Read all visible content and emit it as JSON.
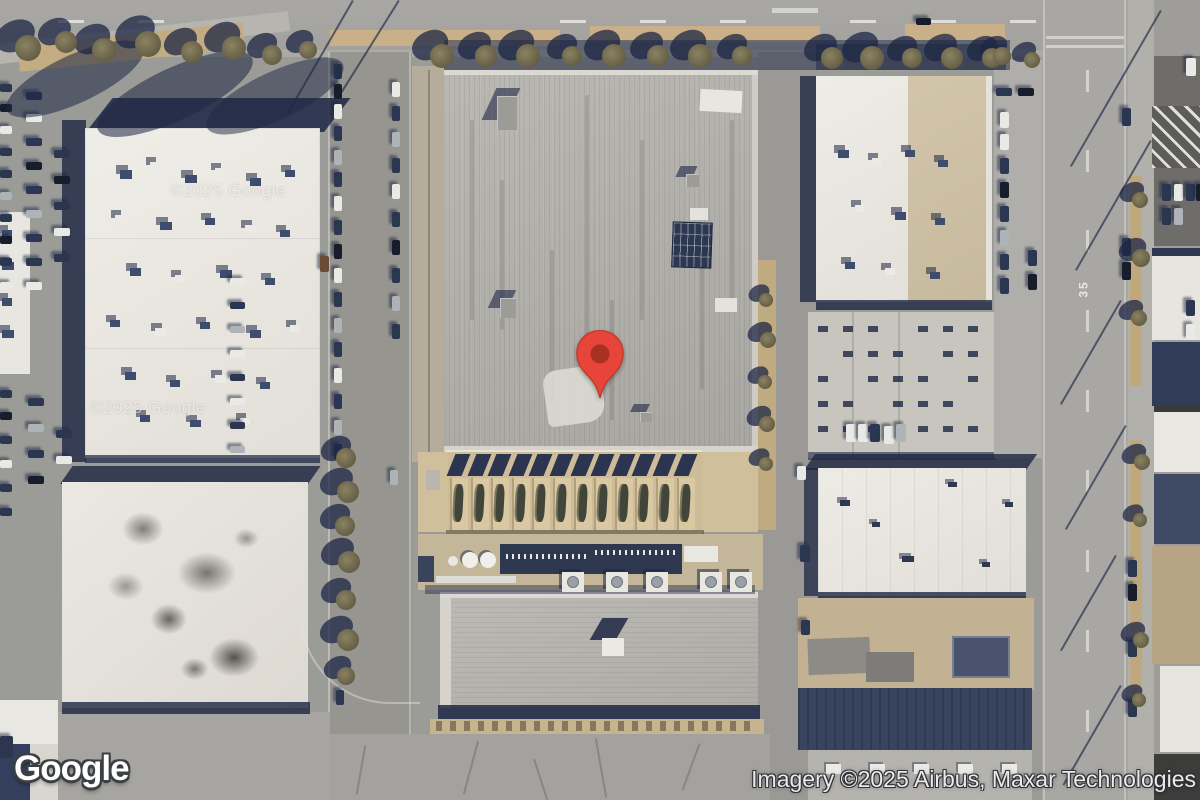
{
  "map": {
    "watermark": "©2025 Google",
    "speed_marking": "35",
    "pin": {
      "body_color": "#E8453A",
      "edge_color": "#C13A2E",
      "dot_color": "#A83124"
    }
  },
  "footer": {
    "logo": "Google",
    "attribution": "Imagery ©2025 Airbus, Maxar Technologies"
  },
  "colors": {
    "shadow_navy": "#1E2744",
    "roof_gray": "#B3B1AC",
    "roof_white": "#ECE9E3",
    "dirt_tan": "#C9B089",
    "asphalt": "#9B9B97"
  }
}
